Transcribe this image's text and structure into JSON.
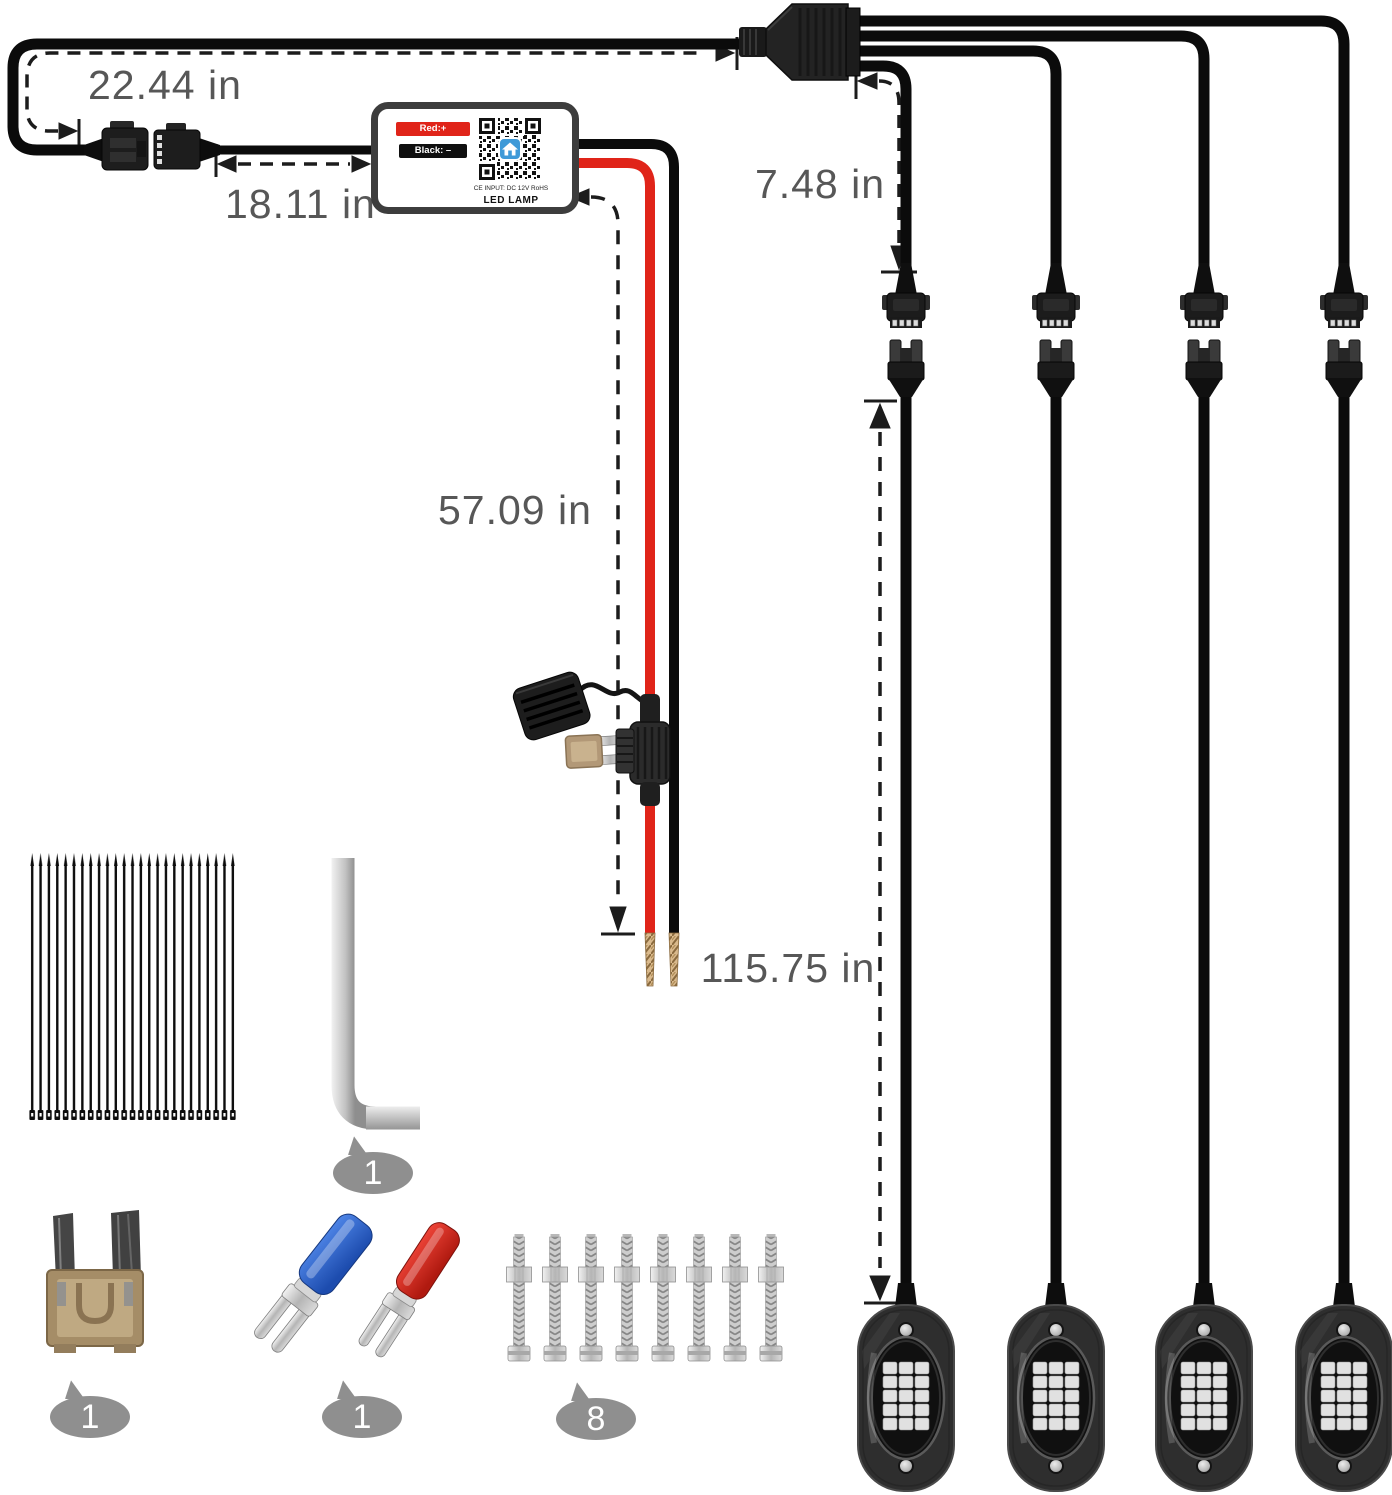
{
  "measurements": {
    "harness_loop": "22.44 in",
    "connector_to_controller": "18.11 in",
    "controller_to_power_leads": "57.09 in",
    "splitter_to_connector": "7.48 in",
    "connector_to_pod": "115.75 in"
  },
  "controller": {
    "red_wire_label": "Red:+",
    "black_wire_label": "Black: –",
    "certification_text": "CE INPUT: DC 12V RoHS",
    "device_label": "LED LAMP"
  },
  "accessory_counts": {
    "hex_key": "1",
    "blade_fuse": "1",
    "spade_terminals": "1",
    "mounting_screws": "8"
  },
  "colors": {
    "wire_red": "#e02419",
    "wire_black": "#0b0b0b",
    "dimension_text": "#575757",
    "badge_background": "#8f8f8f",
    "qr_accent_blue": "#3f9ad8"
  }
}
